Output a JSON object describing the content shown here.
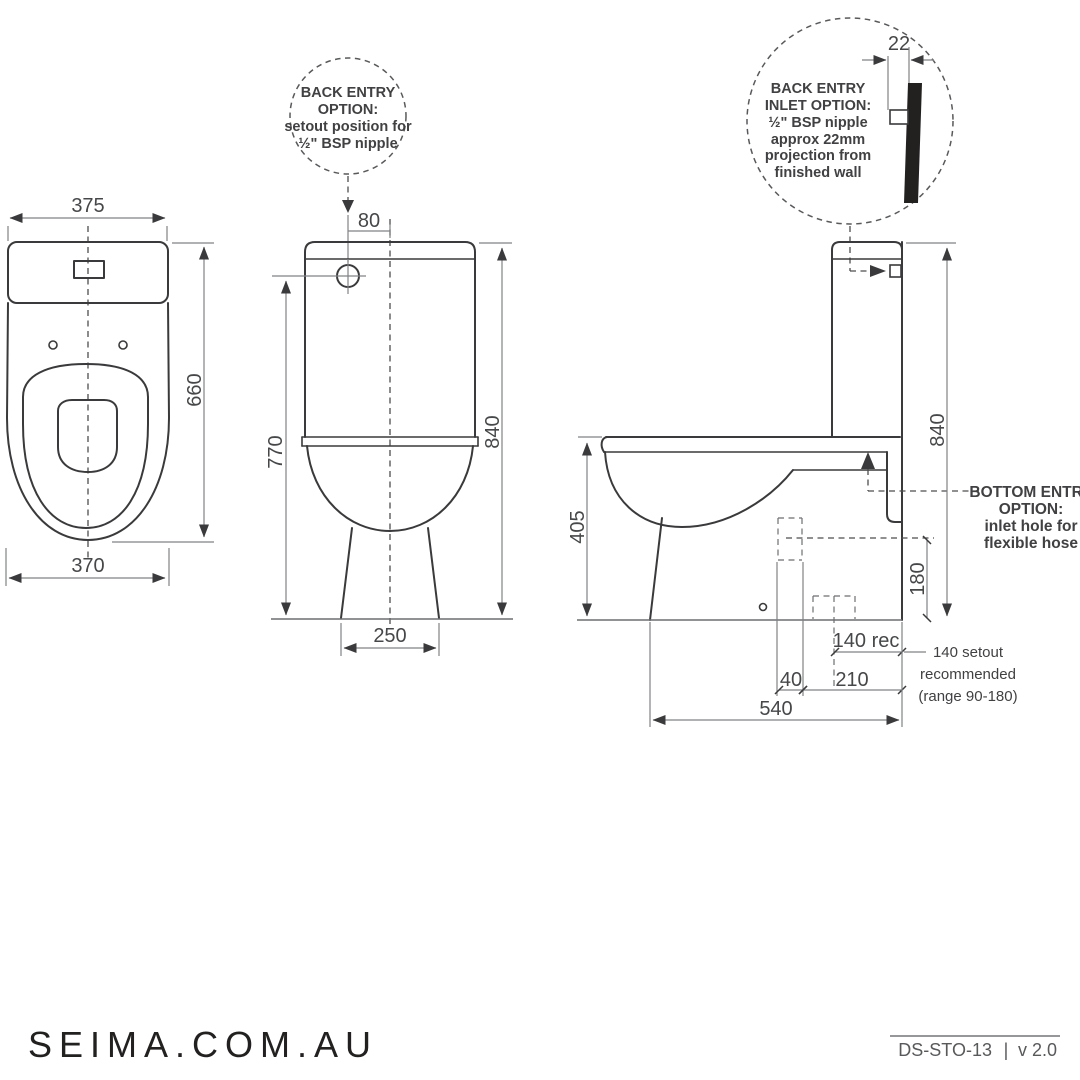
{
  "dimensions": {
    "top_view": {
      "width_top": "375",
      "height": "660",
      "width_bottom": "370"
    },
    "front_view": {
      "inlet_offset": "80",
      "inlet_height": "770",
      "overall_height": "840",
      "base_width": "250"
    },
    "side_view": {
      "nipple_projection": "22",
      "overall_height": "840",
      "bowl_height": "405",
      "inlet_height": "180",
      "setout": "140 rec",
      "offset_40": "40",
      "offset_210": "210",
      "overall_depth": "540"
    }
  },
  "callouts": {
    "back_entry": {
      "lines": [
        "BACK ENTRY",
        "OPTION:",
        "setout position for",
        "½\" BSP nipple"
      ]
    },
    "back_inlet": {
      "lines": [
        "BACK ENTRY",
        "INLET OPTION:",
        "½\" BSP nipple",
        "approx 22mm",
        "projection from",
        "finished wall"
      ]
    },
    "bottom_entry": {
      "lines": [
        "BOTTOM ENTRY",
        "OPTION:",
        "inlet hole for",
        "flexible hose"
      ]
    },
    "setout_recommendation": {
      "lines": [
        "140 setout",
        "recommended",
        "(range 90-180)"
      ]
    }
  },
  "footer": {
    "website": "SEIMA.COM.AU",
    "doc_code": "DS-STO-13",
    "separator": "|",
    "version": "v 2.0"
  },
  "colors": {
    "object_line": "#3a3a3c",
    "dimension_line": "#808285",
    "text": "#464749",
    "dashed": "#4d4d4f"
  }
}
